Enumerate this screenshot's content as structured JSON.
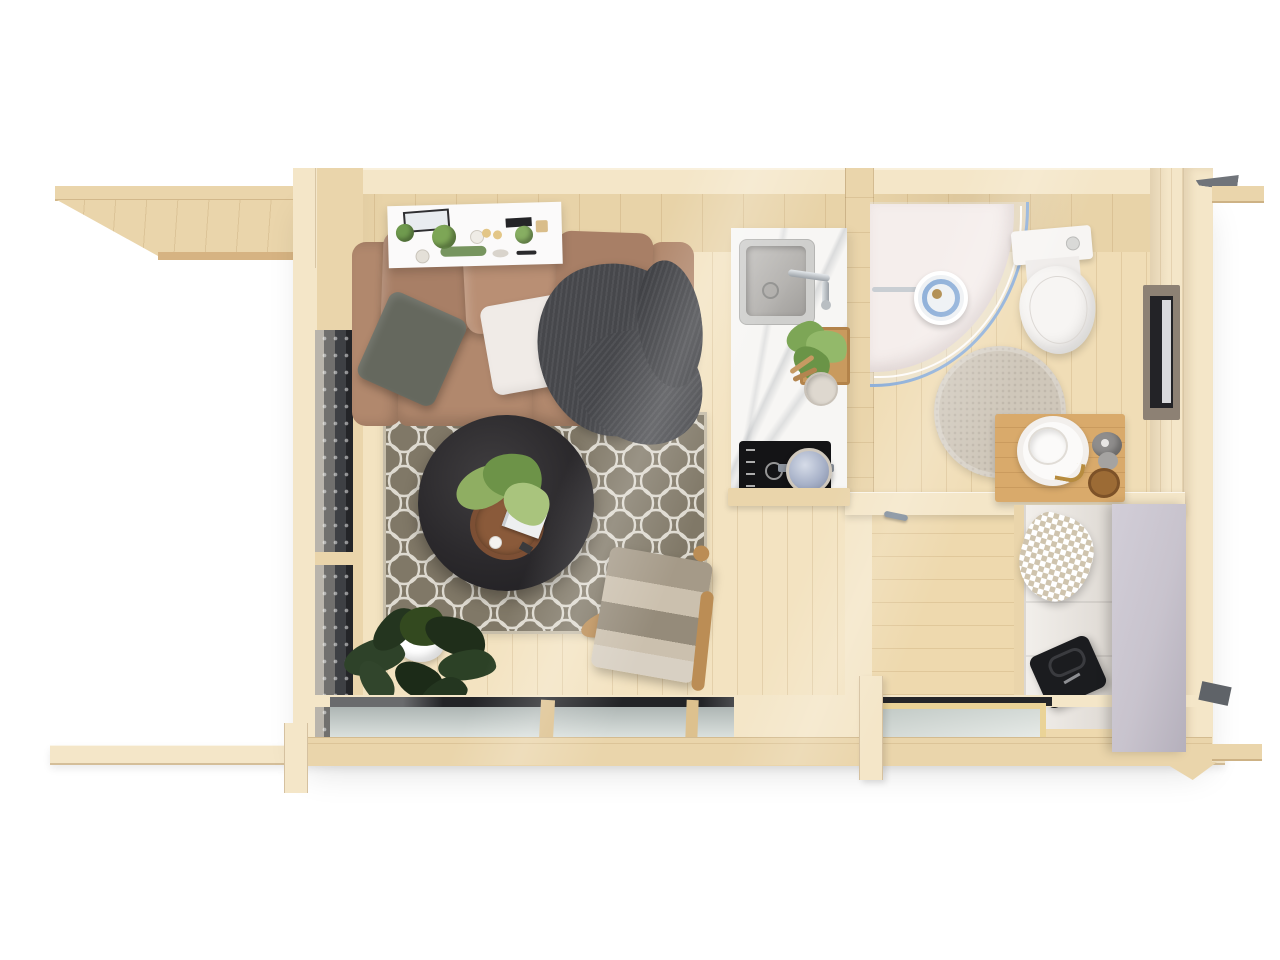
{
  "scene": {
    "description": "Top-down 3D architectural render of a small log cabin: living room with sofa and trellis rug, kitchenette with sink and cooktop, shower room with curved glass shower and toilet, hallway with open wardrobe and gray sliding door, plus porch roof overhang and foundation beams.",
    "background": "#ffffff"
  },
  "palette": {
    "wood_light": "#f4e6c8",
    "wood_mid": "#ead5ab",
    "wood_deep": "#ddc18e",
    "wood_edge": "#d6b382",
    "wall_inner": "#e8d3a8",
    "floor_living": "#f3e3c1",
    "floor_bath": "#f0ddb6",
    "floor_hall": "#eed9ae",
    "grain": "rgba(150,108,50,0.16)",
    "sofa_base": "#b1886d",
    "sofa_cushion": "#b98f74",
    "sofa_cushion_dark": "#a87f66",
    "pillow_gray": "#65685e",
    "pillow_white": "#f0ebe7",
    "throw_dark": "#46474b",
    "rug_base": "#867e6d",
    "rug_line": "#efece2",
    "rug_border": "#c6bda9",
    "pouf_dark": "#2b292c",
    "tray_wood": "#7c4f34",
    "leaf_green": "#7da656",
    "leaf_dark": "#2c3b26",
    "counter_white": "#f7f6f4",
    "steel": "#b4b2af",
    "chrome": "#c9ced3",
    "cooktop_black": "#141416",
    "pot_lid": "#a7b1c8",
    "shower_blue": "#8fb0d9",
    "shower_tray": "#f5eeec",
    "porcelain": "#f7f5f3",
    "bath_rug": "#cfc7ba",
    "vanity_wood": "#d9aa6b",
    "brass": "#b78c3f",
    "stone_gray": "#8f8d8c",
    "win_dark": "#232327",
    "win_taupe": "#8d8174",
    "curtain": "#e9e9ec",
    "glass_cool": "#c6cdca",
    "door_gray": "#c8c3cd",
    "closet_white": "#f2efeb",
    "towel_tan": "#cfc4ae",
    "bag_black": "#1b1c1f",
    "handle_gray": "#7e8b99",
    "blanket_a": "#a59a88",
    "blanket_b": "#cbc0ae",
    "blanket_c": "#958b7a",
    "blanket_d": "#d8d0c3",
    "chair_wood": "#bb8d55"
  },
  "inventory": {
    "porch": [
      "roof-overhang-deck",
      "side-rail-beam",
      "foundation-beam"
    ],
    "living_room": [
      "wall-shelf-with-plants",
      "three-seat-sofa",
      "gray-pillow",
      "white-pillow",
      "dark-knit-throw",
      "trellis-rug",
      "round-dark-ottoman",
      "wooden-serving-tray",
      "tray-plant",
      "magazine",
      "armchair-with-striped-blanket",
      "floor-plant-in-white-pot",
      "glazed-door-left-wall",
      "glazed-windows-bottom-wall"
    ],
    "kitchenette": [
      "white-marble-counter",
      "square-steel-sink",
      "chrome-faucet",
      "herb-planter-box",
      "utensil-cup-with-spoons",
      "induction-cooktop",
      "steel-pot"
    ],
    "shower_room": [
      "curved-glass-shower-enclosure",
      "shower-tray",
      "round-shower-head",
      "toilet-with-cistern",
      "round-beige-rug",
      "wooden-vanity-board",
      "round-vessel-sink",
      "brass-faucet",
      "stone-soap-set",
      "wooden-jar",
      "side-window-right-wall"
    ],
    "hallway": [
      "door-handle",
      "open-wardrobe-white",
      "checked-towel",
      "black-duffel-bag",
      "gray-sliding-door",
      "bottom-window-wood-sash"
    ]
  }
}
